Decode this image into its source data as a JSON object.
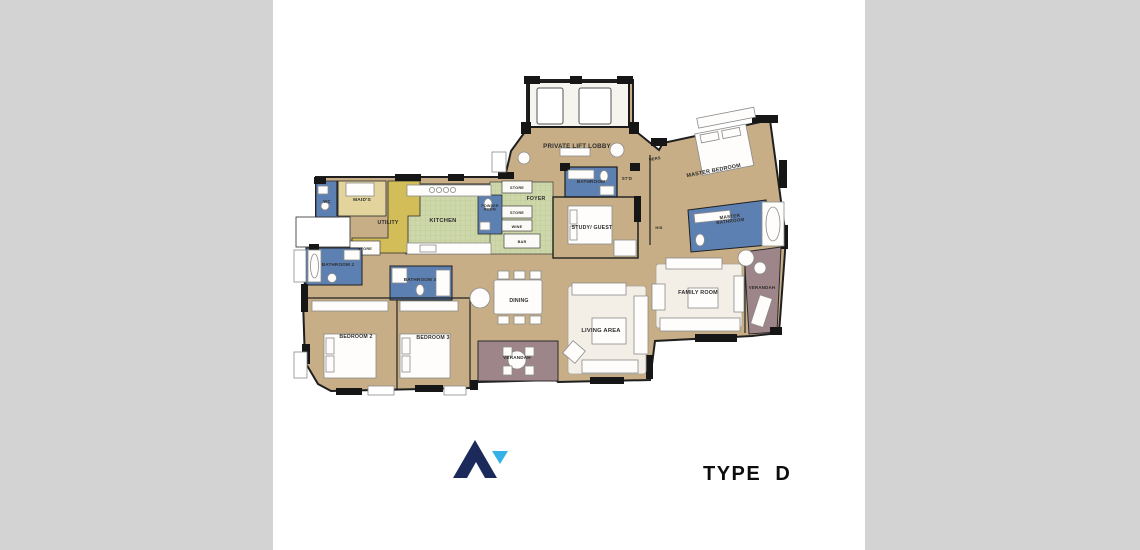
{
  "page": {
    "side_panel_color": "#d3d3d3",
    "canvas_color": "#ffffff"
  },
  "footer": {
    "type_label": "TYPE  D",
    "logo": {
      "icon": "mountain-peak-logo",
      "primary_color": "#1b2a5a",
      "accent_color": "#33b1e6"
    }
  },
  "floorplan": {
    "colors": {
      "wall": "#161616",
      "floor": "#c7ae86",
      "tile_fill": "#cdd7a9",
      "tile_line": "#b9c795",
      "utility": "#d3bd58",
      "maid": "#e3d49e",
      "bathroom": "#5d80b2",
      "veranda": "#9d8589"
    },
    "labels": [
      {
        "id": "private-lift-lobby",
        "text": "PRIVATE LIFT LOBBY",
        "x": 577,
        "y": 148,
        "size": 6.2
      },
      {
        "id": "wc",
        "text": "WC",
        "x": 327,
        "y": 203,
        "size": 4.2
      },
      {
        "id": "maids",
        "text": "MAID'S",
        "x": 362,
        "y": 201,
        "size": 4.8
      },
      {
        "id": "utility",
        "text": "UTILITY",
        "x": 388,
        "y": 224,
        "size": 5.2
      },
      {
        "id": "store-utility",
        "text": "STORE",
        "x": 365,
        "y": 250,
        "size": 3.8
      },
      {
        "id": "kitchen",
        "text": "KITCHEN",
        "x": 443,
        "y": 222,
        "size": 5.8
      },
      {
        "id": "store-upper",
        "text": "STORE",
        "x": 517,
        "y": 189,
        "size": 3.8
      },
      {
        "id": "powder-room",
        "text": "POWDER\nROOM",
        "x": 490,
        "y": 207,
        "size": 3.6
      },
      {
        "id": "store-lower",
        "text": "STORE",
        "x": 517,
        "y": 214,
        "size": 3.8
      },
      {
        "id": "wine",
        "text": "WINE",
        "x": 517,
        "y": 228,
        "size": 3.8
      },
      {
        "id": "bar",
        "text": "BAR",
        "x": 522,
        "y": 243,
        "size": 3.8
      },
      {
        "id": "foyer",
        "text": "FOYER",
        "x": 536,
        "y": 200,
        "size": 5.2
      },
      {
        "id": "bathroom",
        "text": "BATHROOM",
        "x": 591,
        "y": 183,
        "size": 4.6
      },
      {
        "id": "std",
        "text": "ST'D",
        "x": 627,
        "y": 180,
        "size": 4.2
      },
      {
        "id": "study-guest",
        "text": "STUDY/ GUEST",
        "x": 592,
        "y": 229,
        "size": 5.2
      },
      {
        "id": "hers",
        "text": "HERS",
        "x": 655,
        "y": 160,
        "size": 4,
        "rotate": -10
      },
      {
        "id": "master-bedroom",
        "text": "MASTER BEDROOM",
        "x": 714,
        "y": 172,
        "size": 5.4,
        "rotate": -11
      },
      {
        "id": "his",
        "text": "HIS",
        "x": 659,
        "y": 229,
        "size": 4
      },
      {
        "id": "master-bathroom",
        "text": "MASTER\nBATHROOM",
        "x": 730,
        "y": 218,
        "size": 4.6,
        "rotate": -7
      },
      {
        "id": "bathroom-2",
        "text": "BATHROOM 2",
        "x": 338,
        "y": 266,
        "size": 4.6
      },
      {
        "id": "bathroom-3",
        "text": "BATHROOM 3",
        "x": 420,
        "y": 281,
        "size": 4.6
      },
      {
        "id": "bedroom-2",
        "text": "BEDROOM 2",
        "x": 356,
        "y": 338,
        "size": 5.2
      },
      {
        "id": "bedroom-3",
        "text": "BEDROOM 3",
        "x": 433,
        "y": 339,
        "size": 5.2
      },
      {
        "id": "dining",
        "text": "DINING",
        "x": 519,
        "y": 302,
        "size": 5.2
      },
      {
        "id": "verandah-bottom",
        "text": "VERANDAH",
        "x": 517,
        "y": 359,
        "size": 4.6
      },
      {
        "id": "living-area",
        "text": "LIVING AREA",
        "x": 601,
        "y": 332,
        "size": 5.8
      },
      {
        "id": "family-room",
        "text": "FAMILY ROOM",
        "x": 698,
        "y": 294,
        "size": 5.4
      },
      {
        "id": "verandah-right",
        "text": "VERANDAH",
        "x": 762,
        "y": 289,
        "size": 4.4
      }
    ]
  }
}
